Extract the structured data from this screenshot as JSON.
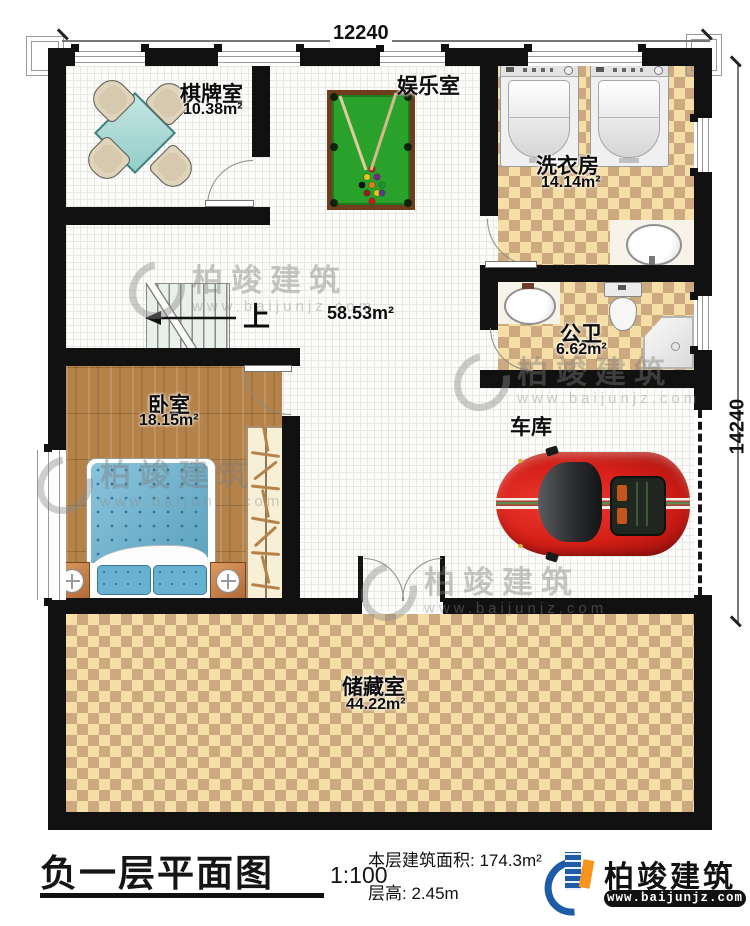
{
  "dimensions": {
    "top": "12240",
    "right": "14240"
  },
  "rooms": {
    "chess": {
      "name": "棋牌室",
      "area": "10.38m²"
    },
    "entertainment": {
      "name": "娱乐室"
    },
    "laundry": {
      "name": "洗衣房",
      "area": "14.14m²"
    },
    "bathroom": {
      "name": "公卫",
      "area": "6.62m²"
    },
    "hall": {
      "area": "58.53m²"
    },
    "garage": {
      "name": "车库"
    },
    "bedroom": {
      "name": "卧室",
      "area": "18.15m²"
    },
    "storage": {
      "name": "储藏室",
      "area": "44.22m²"
    }
  },
  "stairs": {
    "up_label": "上"
  },
  "title_block": {
    "title": "负一层平面图",
    "scale": "1:100",
    "area_label": "本层建筑面积:",
    "area_value": "174.3m²",
    "floor_height_label": "层高:",
    "floor_height_value": "2.45m"
  },
  "brand": {
    "name": "柏竣建筑",
    "website": "www.baijunjz.com"
  },
  "watermark": {
    "text": "柏竣建筑",
    "website": "www.baijunjz.com"
  },
  "colors": {
    "wall": "#111111",
    "checker_light": "#f5dfa7",
    "checker_dark": "#cda97f",
    "wood": "#b5834a",
    "felt_green": "#2aa12a",
    "car_red": "#d41f17",
    "brand_blue": "#1e5ca8",
    "brand_orange": "#f7941d"
  }
}
